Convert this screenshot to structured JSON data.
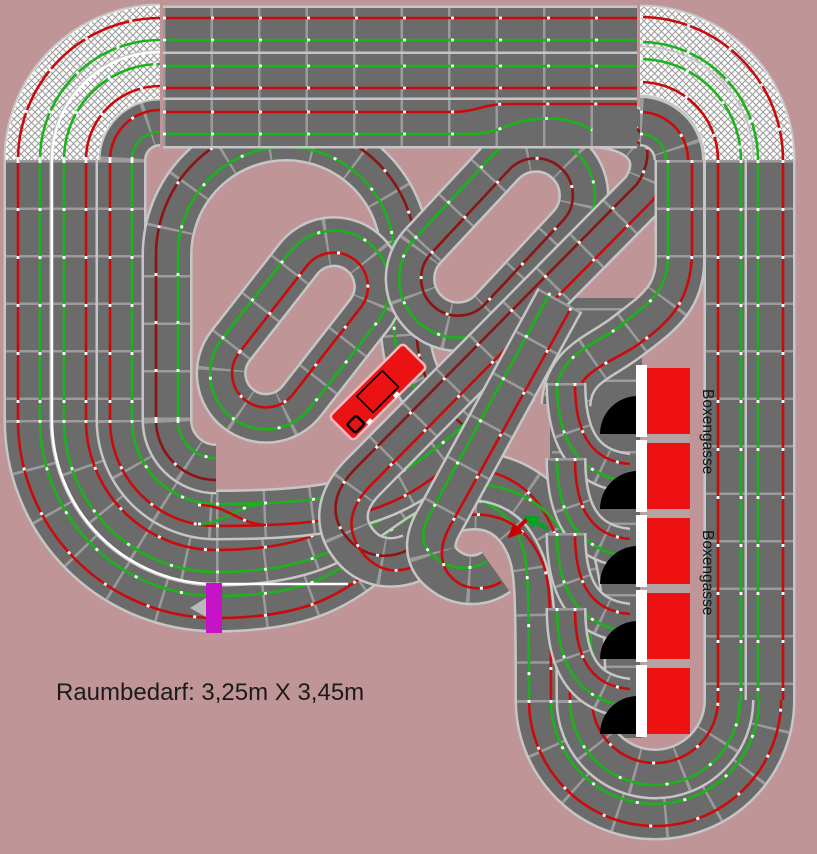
{
  "background_color": "#c09598",
  "note": {
    "text": "Raumbedarf: 3,25m X 3,45m"
  },
  "pit_lane": {
    "label_top": "Boxengasse",
    "label_bottom": "Boxengasse",
    "box_count": 5,
    "box_color": "#ee1111",
    "stall_y_positions": [
      368,
      443,
      518,
      593,
      668
    ],
    "garage_color": "#000000",
    "stripe_color": "#ffffff"
  },
  "track": {
    "surface_color": "#6b6b6b",
    "edge_color": "#c6c6c6",
    "joint_color": "#9b9b9b",
    "lane_red": "#cb0b0b",
    "lane_dark_red": "#8e1414",
    "lane_green": "#1ab41a",
    "slot_tick_color": "#ffffff",
    "bridge_hatch_line_color": "#9c9c9c",
    "bridge_fill_color": "#ffffff"
  },
  "markers": {
    "connector_color": "#c713c7",
    "direction_arrow_red": "#cc0000",
    "direction_arrow_green": "#00a41e",
    "start_arrow_color": "#b9b9b9"
  },
  "control_unit": {
    "color": "#ea1212",
    "outline": "#f6b9b9"
  }
}
